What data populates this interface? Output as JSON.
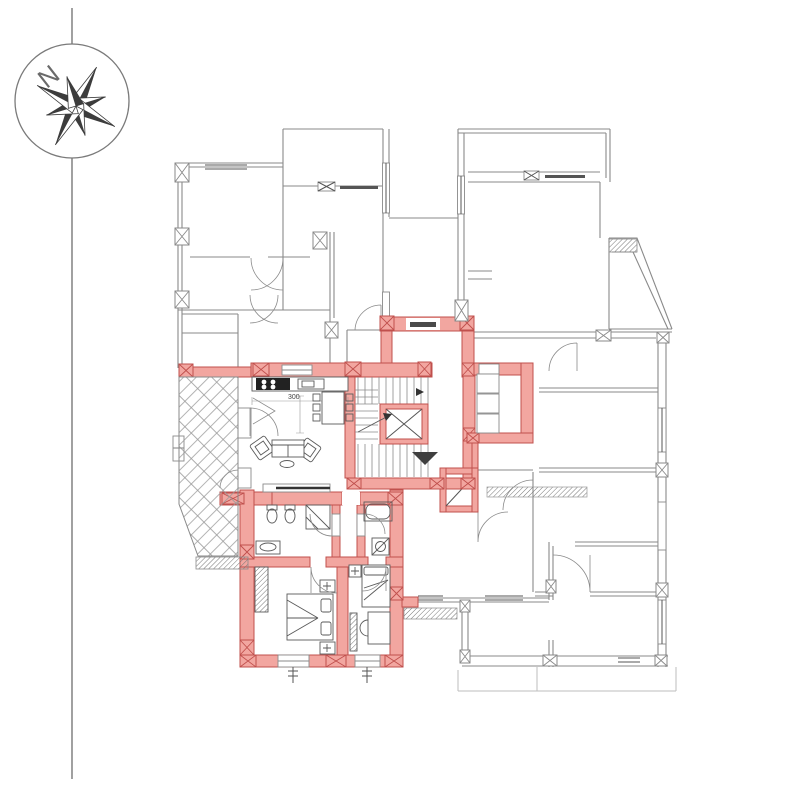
{
  "page": {
    "background": "#FFFFFF",
    "type": "architectural floor plan with one highlighted apartment"
  },
  "compass": {
    "north_label": "N"
  },
  "labels": {
    "kitchen_dimension": "300"
  },
  "colors": {
    "highlight_wall_fill": "#F2A6A0",
    "highlight_wall_stroke": "#C0504D",
    "linework_gray": "#8A8A8A",
    "dark_detail": "#555555",
    "light_gray": "#BDBDBD",
    "furniture": "#5A5A5A",
    "black_fixture": "#222222"
  },
  "icons": {
    "compass_rose": "8-point star in circle",
    "elevator_shaft": "box with X cross",
    "staircase": "parallel treads with direction arrow",
    "entrance_marker": "filled triangle",
    "column": "small box with X"
  }
}
